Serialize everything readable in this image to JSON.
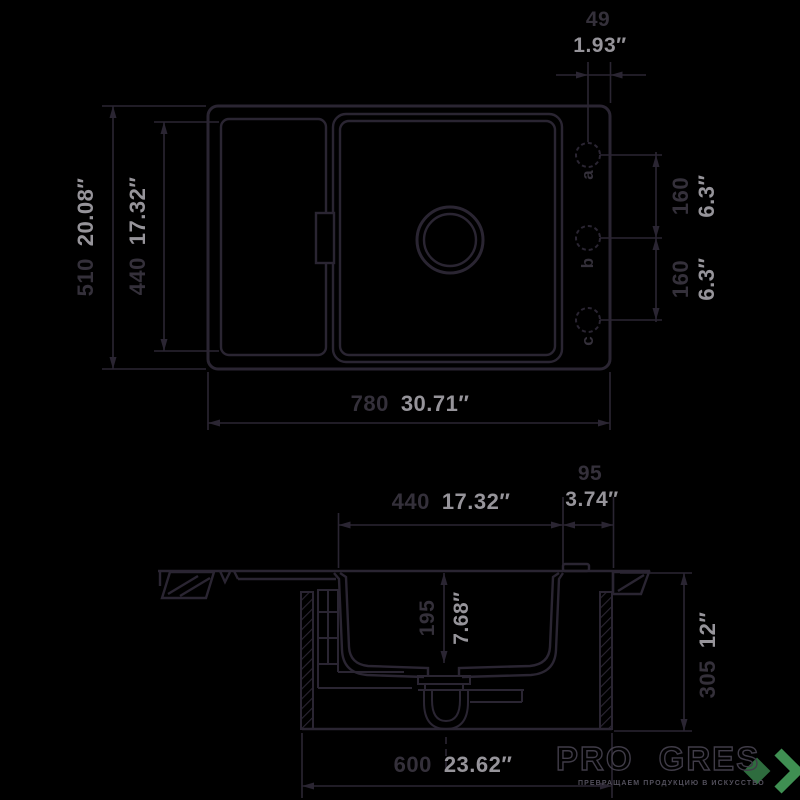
{
  "top_view": {
    "holes": {
      "a": "a",
      "b": "b",
      "c": "c"
    },
    "dims": {
      "hole_edge_offset": {
        "mm": "49",
        "inch": "1.93″"
      },
      "overall_depth": {
        "mm": "510",
        "inch": "20.08″"
      },
      "drainboard_depth": {
        "mm": "440",
        "inch": "17.32″"
      },
      "overall_width": {
        "mm": "780",
        "inch": "30.71″"
      },
      "hole_spacing_ab": {
        "mm": "160",
        "inch": "6.3″"
      },
      "hole_spacing_bc": {
        "mm": "160",
        "inch": "6.3″"
      }
    }
  },
  "section_view": {
    "dims": {
      "bowl_width": {
        "mm": "440",
        "inch": "17.32″"
      },
      "deck_width": {
        "mm": "95",
        "inch": "3.74″"
      },
      "bowl_depth": {
        "mm": "195",
        "inch": "7.68″"
      },
      "cabinet_height": {
        "mm": "305",
        "inch": "12″"
      },
      "cabinet_width": {
        "mm": "600",
        "inch": "23.62″"
      }
    }
  },
  "logo": {
    "brand": "PRO GRES",
    "tagline": "ПРЕВРАЩАЕМ ПРОДУКЦИЮ В ИСКУССТВО",
    "diamond_color": "#2e6c3e",
    "chevron_color": "#3f8f52"
  },
  "colors": {
    "background": "#000000",
    "line": "#2a2532",
    "mm_text": "#34303a",
    "inch_text": "#96949a"
  }
}
